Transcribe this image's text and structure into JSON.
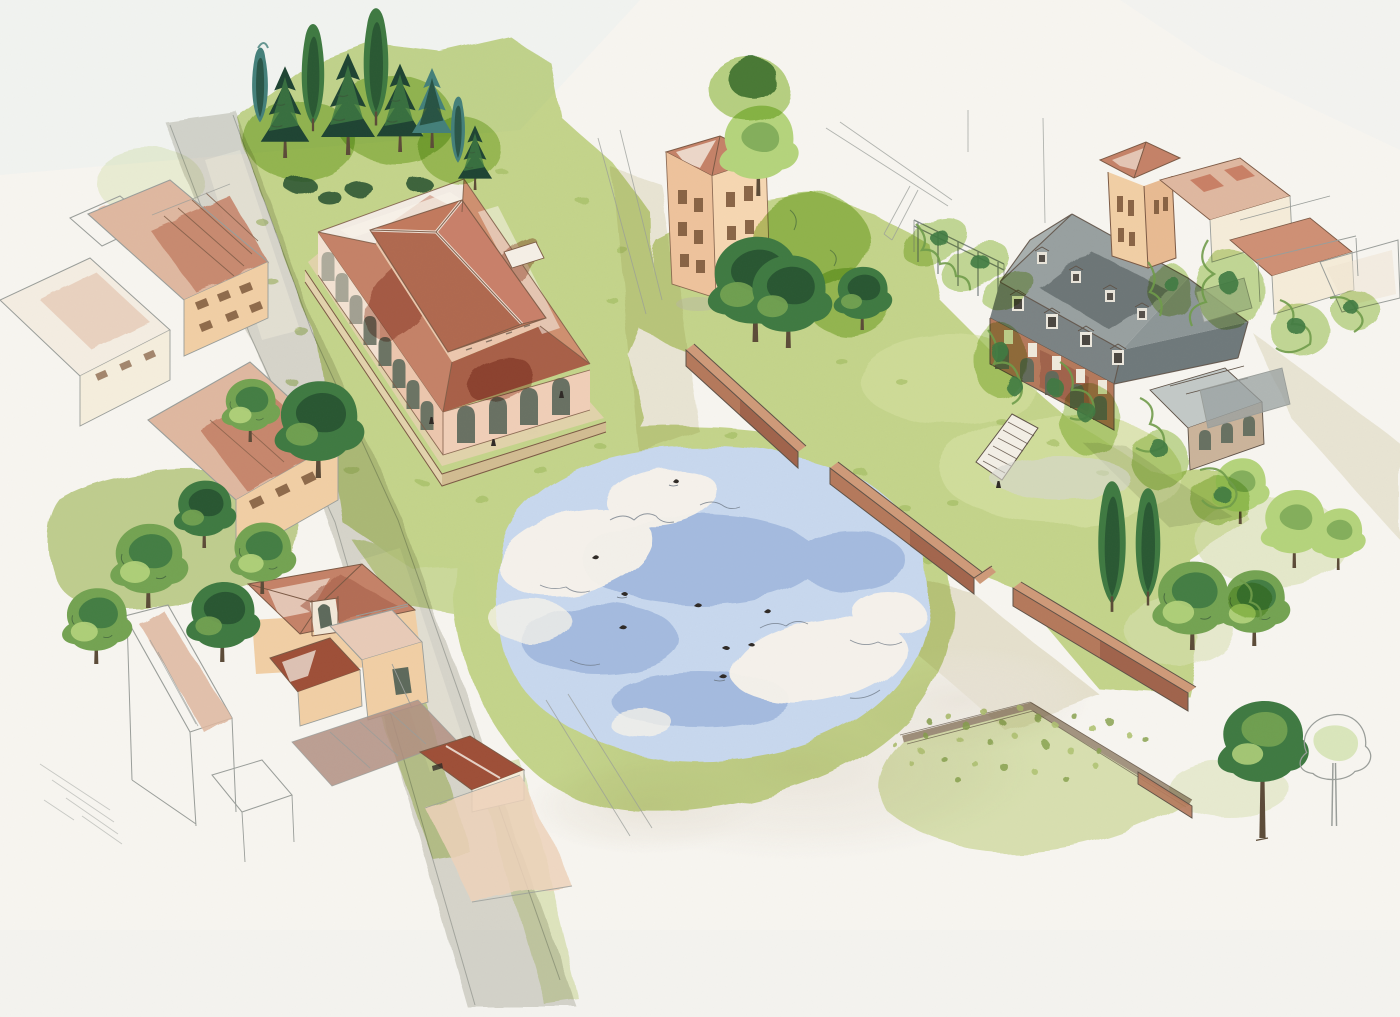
{
  "artwork": {
    "type": "watercolor-and-ink illustration",
    "view": "aerial axonometric village scene",
    "description": "Watercolor aerial illustration of a village: a terracotta-roofed market hall with an arched arcade beside a dark conifer grove, clusters of terracotta-roofed houses sketched in pencil, a pale blue duck pond with cloud reflections, brick garden walls around lawns, a grey mansard-roofed manor covered in climbing vines, cypresses and round trees, and a dotted meadow, all fading into unpainted paper at the edges."
  },
  "palette": {
    "paper": "#f7f5f0",
    "paperCool": "#edf0f0",
    "pencil": "#9a9e9a",
    "ink": "#5f5247",
    "inkWarm": "#7c5a45",
    "inkGreen": "#3a5a3a",
    "grass": "#cbdd94",
    "grassLight": "#e0eabc",
    "grassDark": "#a3bf60",
    "grassOlive": "#b7cc7d",
    "lawnPale": "#dce9ab",
    "foliageLight": "#b5d47c",
    "foliage": "#74a352",
    "foliageDark": "#3f7a42",
    "foliageDeep": "#26512f",
    "coniferTeal": "#44807a",
    "coniferDeep": "#1f4433",
    "scribble": "#6f9c4a",
    "roofRed": "#c58268",
    "roofRedDeep": "#a86048",
    "roofRust": "#9e4f38",
    "roofPale": "#dfb8a0",
    "roofMauve": "#b18f82",
    "wallPeach": "#f1cfa5",
    "wallPink": "#ecc7ae",
    "wallCream": "#f5ecd9",
    "windowBrown": "#7f5a3c",
    "brick": "#b5795c",
    "brickDark": "#935741",
    "brickTop": "#cf9a79",
    "slate": "#98a0a0",
    "slateDark": "#6e7879",
    "slateLight": "#c3c9c7",
    "water": "#c8d8ee",
    "waterDeep": "#b2c7e5",
    "waterInk": "#6b7683",
    "pathGray": "#d8d8d1",
    "pathCream": "#eae7d4",
    "sand": "#e3d3ad",
    "meadow": "#dfe9bb",
    "meadowBorder": "#a89a88",
    "dotGreen": "#8fab56",
    "archGlass": "#5e6a5c",
    "trunk": "#5c4b38",
    "highlight": "#f8f3ea",
    "figure": "#2f2a26"
  },
  "scene": {
    "market_hall": {
      "roof": "terracotta hipped roof with raised clerestory",
      "long_side_arches": 8,
      "end_arches": 4
    },
    "pond": {
      "bird_count": 9,
      "cloud_reflections": 3
    },
    "manor": {
      "roof": "grey mansard",
      "dormer_count": 8,
      "arcade_arches": 5,
      "features": "vine-covered brick facade with outdoor staircase and green trellis"
    },
    "conifer_grove": {
      "tree_count": 9
    },
    "garden_walls": {
      "material": "terracotta brick",
      "segments": 4
    },
    "meadow": {
      "dotted": true
    },
    "style_notes": "pencil underdrawing left visible; washes fade to blank paper at the sheet edges"
  }
}
